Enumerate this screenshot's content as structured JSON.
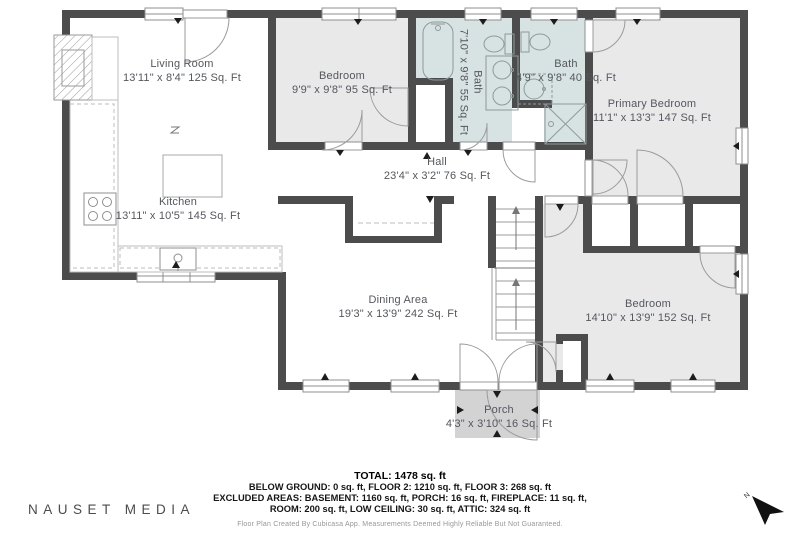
{
  "floorplan": {
    "rooms": [
      {
        "id": "living-room",
        "name": "Living Room",
        "dims": "13'11\" x 8'4\" 125 Sq. Ft"
      },
      {
        "id": "bedroom-top",
        "name": "Bedroom",
        "dims": "9'9\" x 9'8\" 95 Sq. Ft"
      },
      {
        "id": "bath-main",
        "name": "Bath",
        "dims": "7'10\" x 9'8\" 55 Sq. Ft"
      },
      {
        "id": "bath-small",
        "name": "Bath",
        "dims": "4'9\" x 9'8\" 40 Sq. Ft"
      },
      {
        "id": "primary-bedroom",
        "name": "Primary Bedroom",
        "dims": "11'1\" x 13'3\" 147 Sq. Ft"
      },
      {
        "id": "hall",
        "name": "Hall",
        "dims": "23'4\" x 3'2\" 76 Sq. Ft"
      },
      {
        "id": "kitchen",
        "name": "Kitchen",
        "dims": "13'11\" x 10'5\" 145 Sq. Ft"
      },
      {
        "id": "dining-area",
        "name": "Dining Area",
        "dims": "19'3\" x 13'9\" 242 Sq. Ft"
      },
      {
        "id": "bedroom-bottom",
        "name": "Bedroom",
        "dims": "14'10\" x 13'9\" 152 Sq. Ft"
      },
      {
        "id": "porch",
        "name": "Porch",
        "dims": "4'3\" x 3'10\" 16 Sq. Ft"
      }
    ]
  },
  "summary": {
    "total": "TOTAL: 1478 sq. ft",
    "line2": "BELOW GROUND: 0 sq. ft, FLOOR 2: 1210 sq. ft, FLOOR 3: 268 sq. ft",
    "line3": "EXCLUDED AREAS: BASEMENT: 1160 sq. ft, PORCH: 16 sq. ft, FIREPLACE: 11 sq. ft,",
    "line4": "ROOM: 200 sq. ft, LOW CEILING: 30 sq. ft, ATTIC: 324 sq. ft",
    "disclaimer": "Floor Plan Created By Cubicasa App. Measurements Deemed Highly Reliable But Not Guaranteed."
  },
  "branding": {
    "logo_text": "NAUSET MEDIA"
  },
  "compass": {
    "label": "N"
  },
  "colors": {
    "wall": "#4c4c4c",
    "room_fill": "#e9e9e9",
    "bath_fill": "#d7e2e2",
    "porch_fill": "#d3d3d3",
    "label_text": "#54575e"
  }
}
